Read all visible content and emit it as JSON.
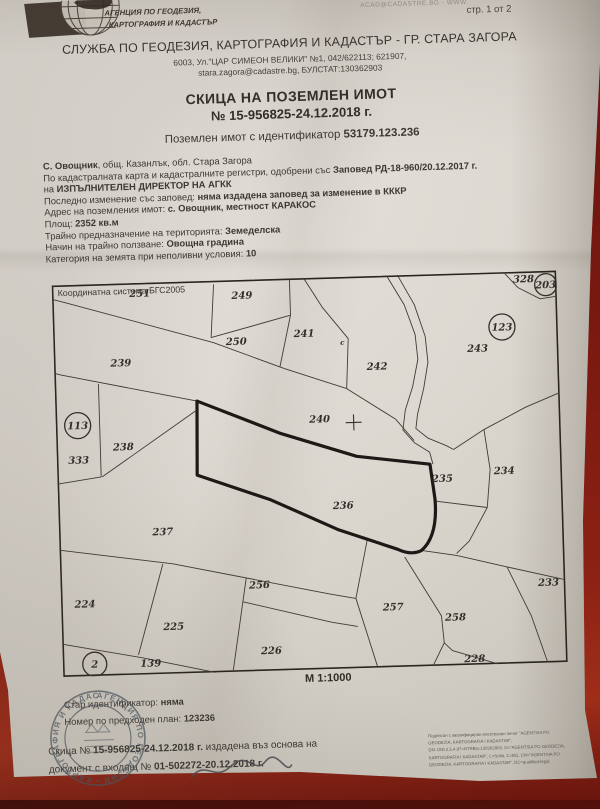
{
  "page": {
    "indicator": "стр. 1 от 2",
    "watermark": "ACAD@CADASTRE.BG - WWW."
  },
  "agency": {
    "logo_line1": "АГЕНЦИЯ ПО ГЕОДЕЗИЯ,",
    "logo_line2": "КАРТОГРАФИЯ И КАДАСТЪР"
  },
  "office": {
    "name": "СЛУЖБА ПО ГЕОДЕЗИЯ, КАРТОГРАФИЯ И КАДАСТЪР - ГР. СТАРА ЗАГОРА",
    "address": "6003, Ул.\"ЦАР СИМЕОН ВЕЛИКИ\" №1, 042/622113; 621907,",
    "contact": "stara.zagora@cadastre.bg, БУЛСТАТ:130362903"
  },
  "title": {
    "line1": "СКИЦА НА ПОЗЕМЛЕН ИМОТ",
    "line2": "№ 15-956825-24.12.2018 г.",
    "subtitle_pre": "Поземлен имот с идентификатор ",
    "subtitle_id": "53179.123.236"
  },
  "details": {
    "lines": [
      [
        {
          "t": "С. Овощник",
          "b": true
        },
        {
          "t": ", общ. Казанлък, обл. Стара Загора",
          "b": false
        }
      ],
      [
        {
          "t": "По кадастралната карта и кадастралните регистри, одобрени със ",
          "b": false
        },
        {
          "t": "Заповед РД-18-960/20.12.2017 г.",
          "b": true
        }
      ],
      [
        {
          "t": "на ",
          "b": false
        },
        {
          "t": "ИЗПЪЛНИТЕЛЕН ДИРЕКТОР НА АГКК",
          "b": true
        }
      ],
      [
        {
          "t": "Последно изменение със заповед: ",
          "b": false
        },
        {
          "t": "няма издадена заповед за изменение в КККР",
          "b": true
        }
      ],
      [
        {
          "t": "Адрес на поземления имот: ",
          "b": false
        },
        {
          "t": "с. Овощник, местност КАРАКОС",
          "b": true
        }
      ],
      [
        {
          "t": "Площ: ",
          "b": false
        },
        {
          "t": "2352 кв.м",
          "b": true
        }
      ],
      [
        {
          "t": "Трайно предназначение на територията: ",
          "b": false
        },
        {
          "t": "Земеделска",
          "b": true
        }
      ],
      [
        {
          "t": "Начин на трайно ползване: ",
          "b": false
        },
        {
          "t": "Овощна градина",
          "b": true
        }
      ],
      [
        {
          "t": "Категория на земята при неполивни условия: ",
          "b": false
        },
        {
          "t": "10",
          "b": true
        }
      ]
    ]
  },
  "map": {
    "coordinate_system": "Координатна система БГС2005",
    "scale": "М 1:1000",
    "subject_parcel": "236",
    "parcel_labels": [
      {
        "n": "251",
        "x": 88,
        "y": 14
      },
      {
        "n": "249",
        "x": 190,
        "y": 19
      },
      {
        "n": "250",
        "x": 183,
        "y": 65
      },
      {
        "n": "241",
        "x": 251,
        "y": 59
      },
      {
        "n": "c",
        "x": 289,
        "y": 68,
        "small": true
      },
      {
        "n": "242",
        "x": 323,
        "y": 94
      },
      {
        "n": "243",
        "x": 424,
        "y": 79
      },
      {
        "n": "328",
        "x": 472,
        "y": 11
      },
      {
        "n": "239",
        "x": 67,
        "y": 83
      },
      {
        "n": "333",
        "x": 22,
        "y": 179
      },
      {
        "n": "238",
        "x": 67,
        "y": 167
      },
      {
        "n": "240",
        "x": 264,
        "y": 145
      },
      {
        "n": "237",
        "x": 104,
        "y": 253
      },
      {
        "n": "236",
        "x": 285,
        "y": 232
      },
      {
        "n": "235",
        "x": 385,
        "y": 208
      },
      {
        "n": "234",
        "x": 447,
        "y": 202
      },
      {
        "n": "224",
        "x": 24,
        "y": 323
      },
      {
        "n": "225",
        "x": 112,
        "y": 348
      },
      {
        "n": "256",
        "x": 199,
        "y": 309
      },
      {
        "n": "139",
        "x": 88,
        "y": 384
      },
      {
        "n": "226",
        "x": 209,
        "y": 375
      },
      {
        "n": "257",
        "x": 332,
        "y": 335
      },
      {
        "n": "258",
        "x": 394,
        "y": 347
      },
      {
        "n": "233",
        "x": 488,
        "y": 315
      },
      {
        "n": "228",
        "x": 412,
        "y": 389
      }
    ],
    "circled_labels": [
      {
        "n": "113",
        "cx": 22,
        "cy": 141,
        "r": 13
      },
      {
        "n": "123",
        "cx": 449,
        "cy": 55,
        "r": 13
      },
      {
        "n": "203",
        "cx": 494,
        "cy": 14,
        "r": 11
      },
      {
        "n": "2",
        "cx": 32,
        "cy": 380,
        "r": 12
      }
    ]
  },
  "footer": {
    "previds": [
      [
        {
          "t": "Стар идентификатор: ",
          "b": false
        },
        {
          "t": "няма",
          "b": true
        }
      ],
      [
        {
          "t": "Номер по предходен план: ",
          "b": false
        },
        {
          "t": "123236",
          "b": true
        }
      ]
    ],
    "issue_lines": [
      [
        {
          "t": "Скица № ",
          "b": false
        },
        {
          "t": "15-956825-24.12.2018 г.",
          "b": true
        },
        {
          "t": " издадена въз основа на",
          "b": false
        }
      ],
      [
        {
          "t": "документ с входящ № ",
          "b": false
        },
        {
          "t": "01-502272-20.12.2018 г.",
          "b": true
        }
      ]
    ],
    "stamp_ring_text": "АГЕНЦИЯ ПО ГЕОДЕЗИЯ • КАРТОГРАФИЯ И КАДАСТЪР • ",
    "signature_block": [
      "Подписан с квалифициран електронен печат \"AGENTSIA PO",
      "GEODEZIA, KARTOGRAFIA I KADASTAR\",",
      "DN: OID.2.5.4.97=NTRBG-130362903, O=\"AGENTSIA PO GEODEZIA,",
      "KARTOGRAFIA I KADASTAR\", L=Sofia, C=BG, CN=\"AGENTSIA PO",
      "GEODEZIA, KARTOGRAFIA I KADASTAR\", DC=qualified-legal"
    ]
  }
}
